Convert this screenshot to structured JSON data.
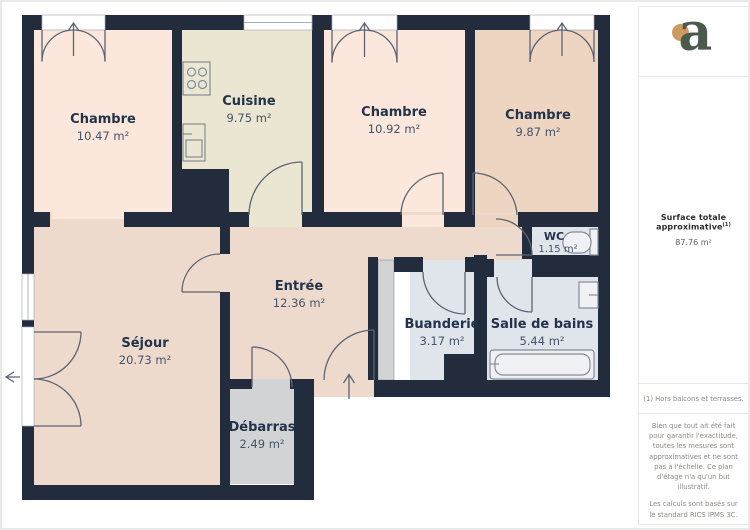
{
  "plan": {
    "rooms": [
      {
        "id": "chambre-1",
        "name": "Chambre",
        "area": "10.47 m²"
      },
      {
        "id": "cuisine",
        "name": "Cuisine",
        "area": "9.75 m²"
      },
      {
        "id": "chambre-2",
        "name": "Chambre",
        "area": "10.92 m²"
      },
      {
        "id": "chambre-3",
        "name": "Chambre",
        "area": "9.87 m²"
      },
      {
        "id": "wc",
        "name": "WC",
        "area": "1.15 m²"
      },
      {
        "id": "entree",
        "name": "Entrée",
        "area": "12.36 m²"
      },
      {
        "id": "sejour",
        "name": "Séjour",
        "area": "20.73 m²"
      },
      {
        "id": "buanderie",
        "name": "Buanderie",
        "area": "3.17 m²"
      },
      {
        "id": "salle-de-bains",
        "name": "Salle de bains",
        "area": "5.44 m²"
      },
      {
        "id": "debarras",
        "name": "Débarras",
        "area": "2.49 m²"
      }
    ],
    "colors": {
      "wall": "#232c3c",
      "bedroom_fill": "#fbe7db",
      "kitchen_fill": "#eae6d1",
      "bedroom3_fill": "#edd5c1",
      "living_fill": "#eedacc",
      "storage_fill": "#d2d3d4",
      "wet_room_fill": "#e0e4eb"
    }
  },
  "sidebar": {
    "logo_letter": "a",
    "logo_colors": {
      "letter": "#4b5a4c",
      "dot": "#cf9a62"
    },
    "surface_label": "Surface totale approximative",
    "surface_sup": "(1)",
    "surface_value": "87.76 m²",
    "footnote": "(1) Hors balcons et terrasses.",
    "disclaimer_1": "Bien que tout ait été fait pour garantir l'exactitude, toutes les mesures sont approximatives et ne sont pas à l'échelle. Ce plan d'étage n'a qu'un but illustratif.",
    "disclaimer_2": "Les calculs sont basés sur le standard RICS IPMS 3C.",
    "brand_name": "GIRAFFE",
    "brand_suffix": "360"
  }
}
